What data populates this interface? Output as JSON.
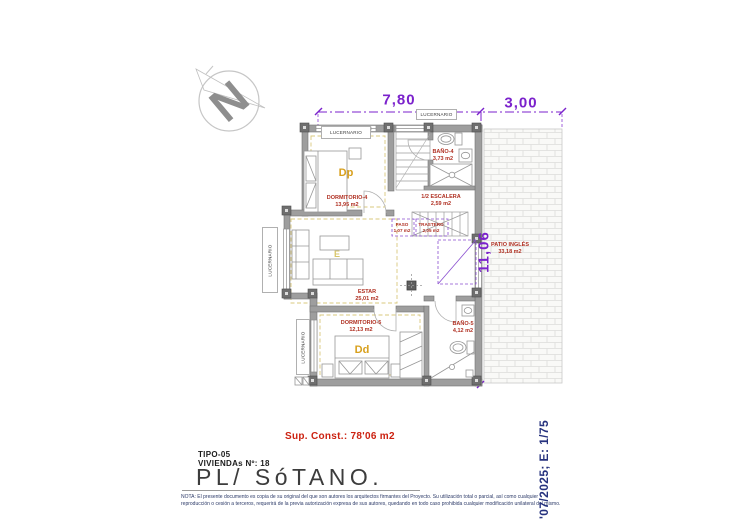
{
  "compass": {
    "north_letter": "N"
  },
  "dimensions": {
    "top_width": "7,80",
    "top_patio_width": "3,00",
    "right_height": "11,06"
  },
  "skylight_label": "LUCERNARIO",
  "rooms": {
    "dormitorio4": {
      "name": "DORMITORIO-4",
      "area": "13,95 m2",
      "code": "Dp"
    },
    "bano4": {
      "name": "BAÑO-4",
      "area": "3,73 m2"
    },
    "escalera": {
      "name": "1/2 ESCALERA",
      "area": "2,59 m2"
    },
    "paso": {
      "name": "PASO",
      "area": "1,07 m2"
    },
    "trastero": {
      "name": "TRASTERO",
      "area": "2,05 m2"
    },
    "estar": {
      "name": "ESTAR",
      "area": "25,01 m2",
      "code": "E"
    },
    "dormitorio5": {
      "name": "DORMITORIO-5",
      "area": "12,13 m2",
      "code": "Dd"
    },
    "bano5": {
      "name": "BAÑO-5",
      "area": "4,12 m2"
    },
    "patio_ingles": {
      "name": "PATIO INGLÉS",
      "area": "33,18 m2"
    }
  },
  "title_block": {
    "sup_const": "Sup. Const.: 78'06 m2",
    "tipo": "TIPO-05",
    "viviendas": "VIVIENDAs Nº: 18",
    "plano": "PL/ SóTANO.",
    "nota": "NOTA: El presente documento es copia de su original del que son autores los arquitectos firmantes del Proyecto. Su utilización total o parcial, así como cualquier reproducción o cesión a terceros, requerirá de la previa autorización expresa de sus autores, quedando en todo caso prohibida cualquier modificación unilateral del mismo."
  },
  "revision": {
    "date_scale": "'07/2025; E: 1/75"
  },
  "colors": {
    "dimension_purple": "#7b22cc",
    "label_red": "#b03022",
    "room_code_yellow": "#d8a01d",
    "wall_gray": "#9e9e9e",
    "note_navy": "#2c3a68"
  }
}
